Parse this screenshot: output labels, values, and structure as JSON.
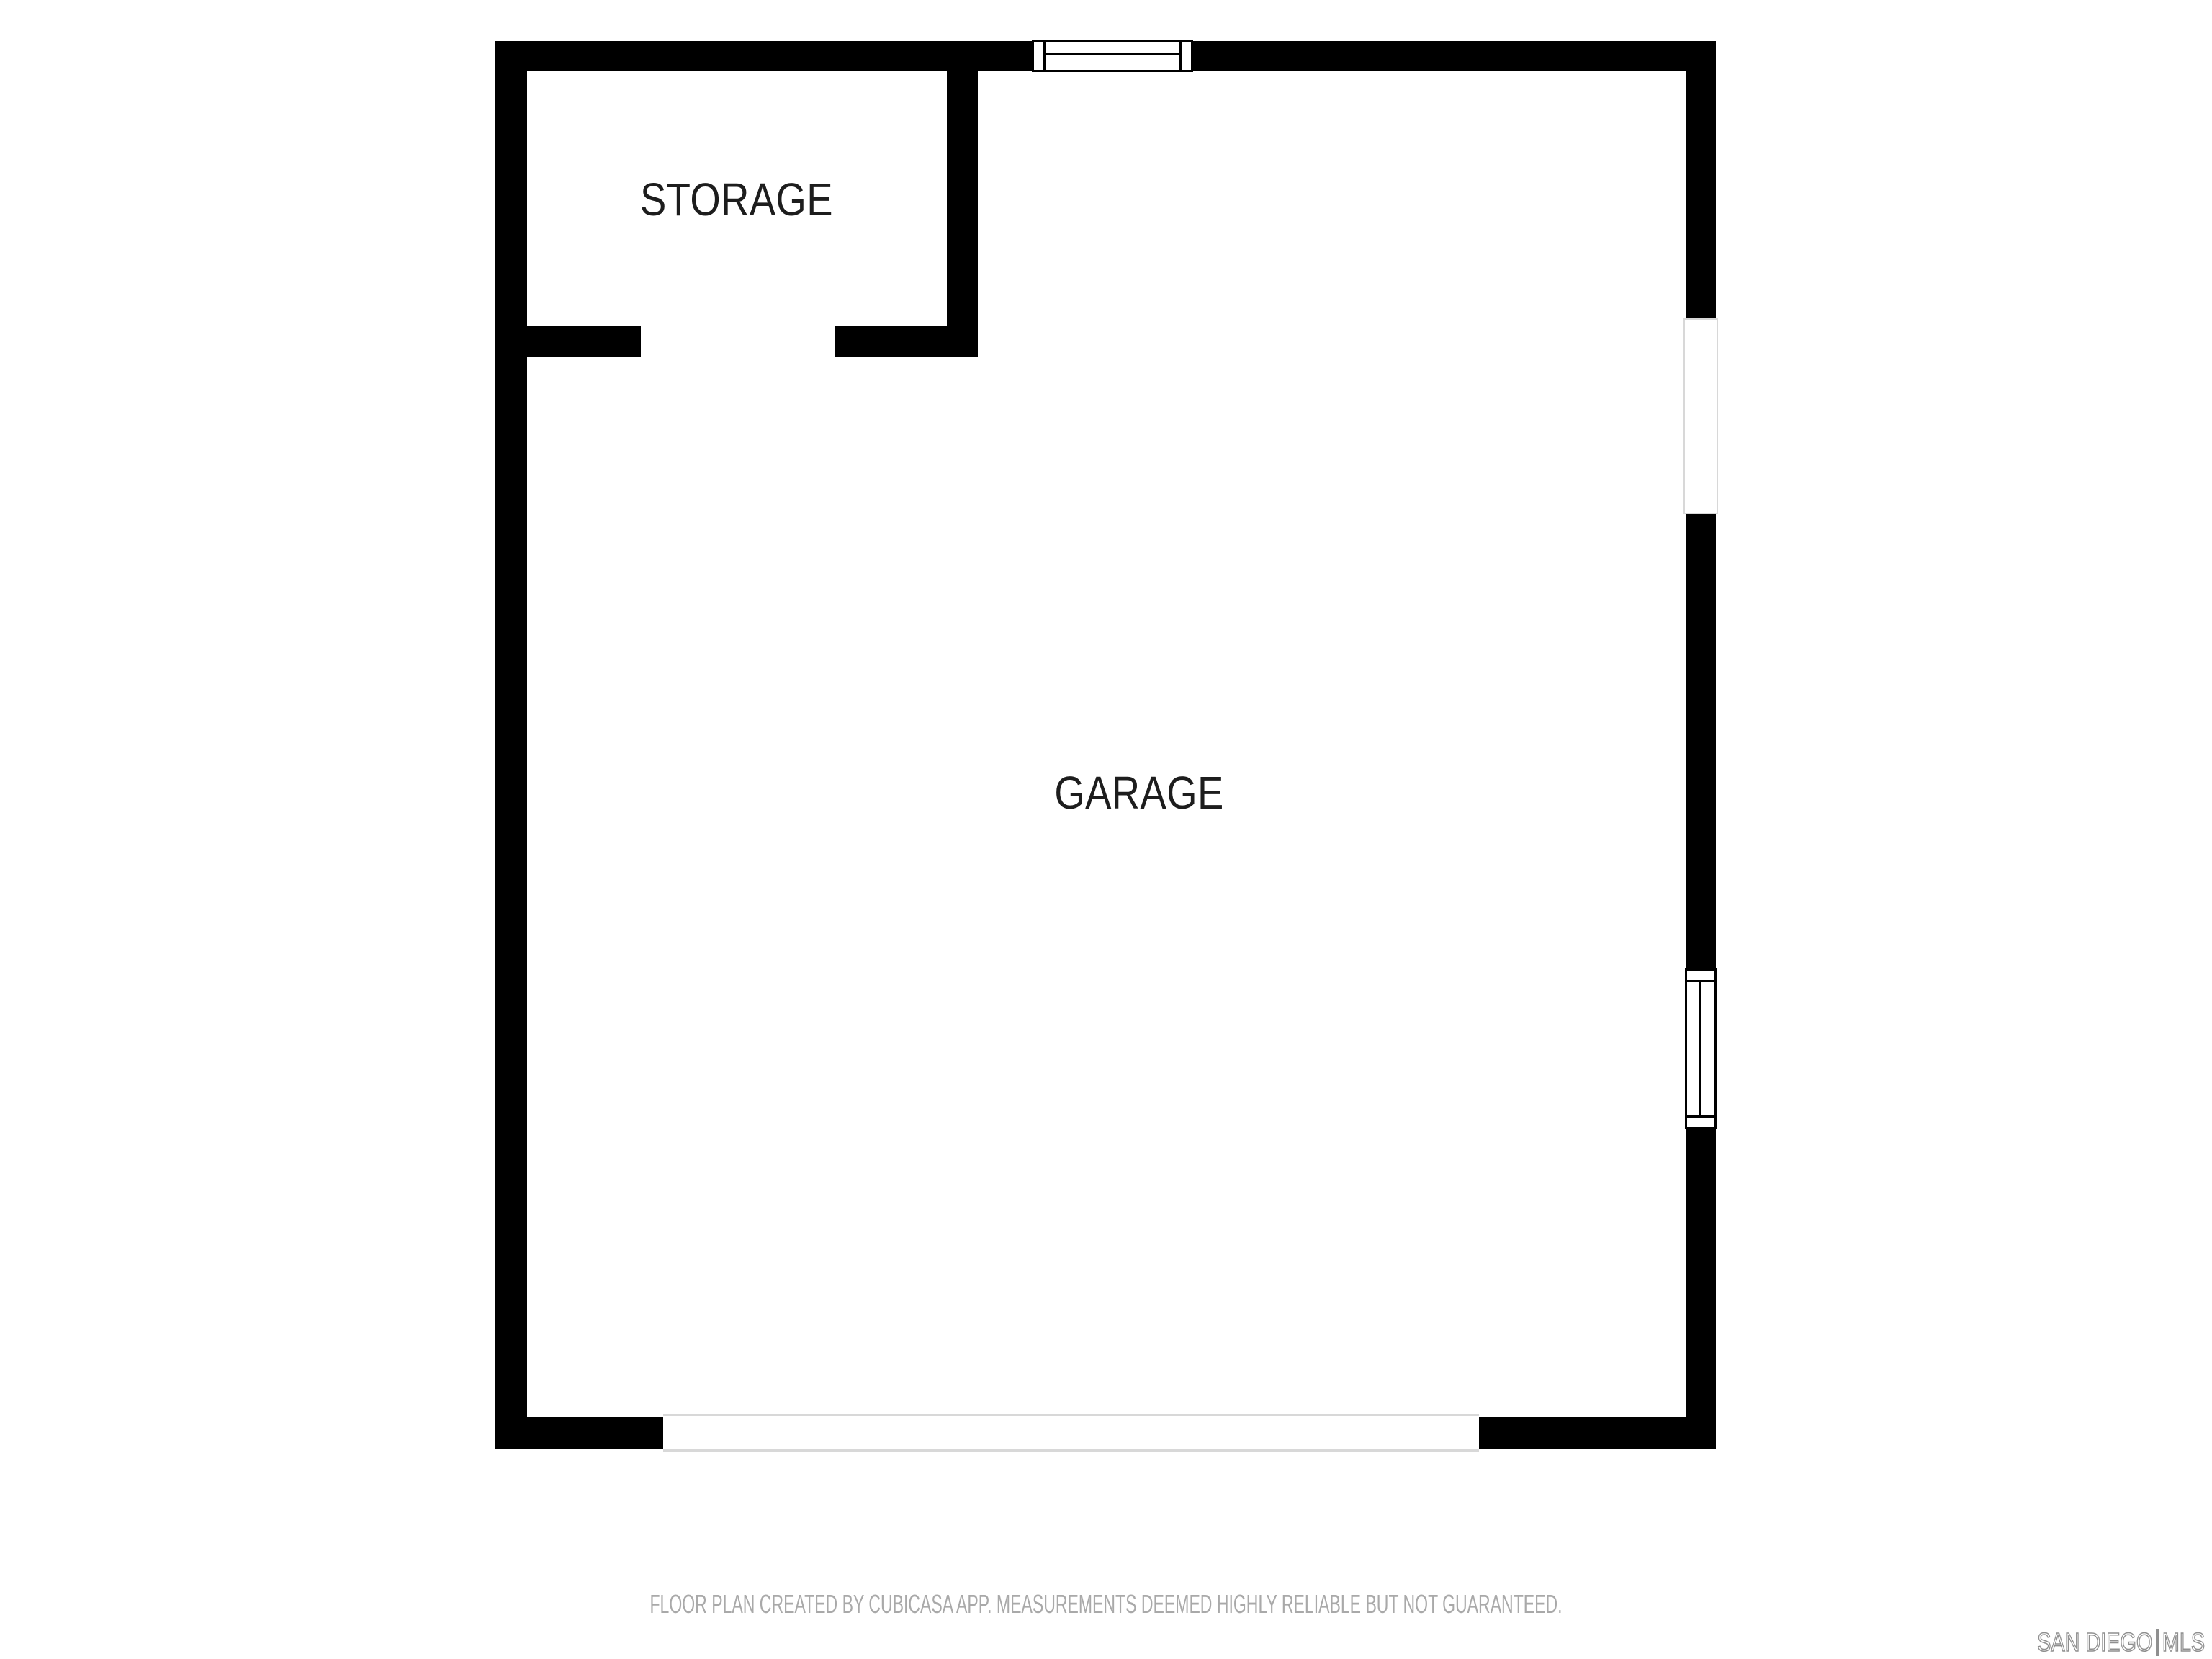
{
  "colors": {
    "background": "#ffffff",
    "wall": "#000000",
    "room_label": "#1d1d1d",
    "disclaimer_text": "#a9a9a9",
    "watermark": "#8f8f8f",
    "opening_border": "#d8d8d8"
  },
  "rooms": [
    {
      "name": "STORAGE"
    },
    {
      "name": "GARAGE"
    }
  ],
  "features": {
    "windows": [
      "window-top-wall",
      "window-right-wall"
    ],
    "openings": [
      "doorway-right-wall",
      "garage-door-opening-bottom-wall",
      "storage-door-opening"
    ]
  },
  "footer": {
    "disclaimer": "FLOOR PLAN CREATED BY CUBICASA APP. MEASUREMENTS DEEMED HIGHLY RELIABLE BUT NOT GUARANTEED.",
    "watermark_left": "SAN DIEGO",
    "watermark_right": "MLS"
  }
}
